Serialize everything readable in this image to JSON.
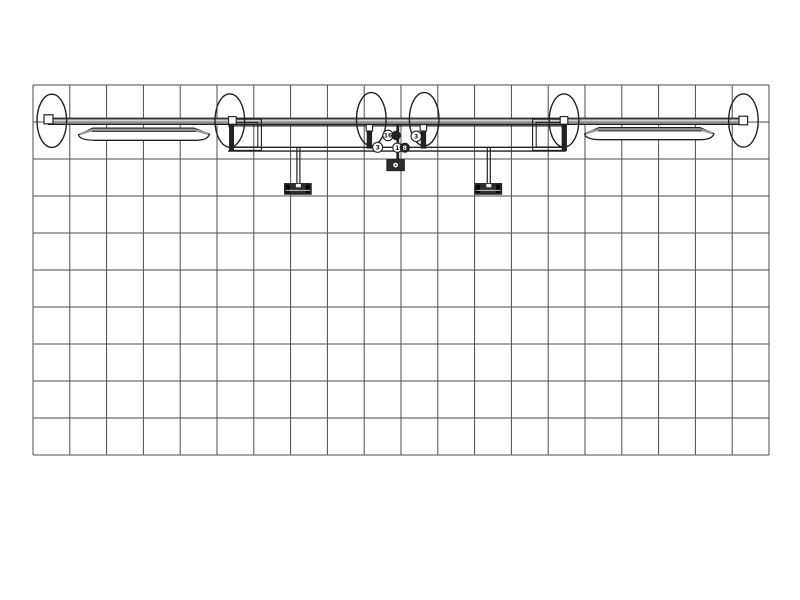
{
  "drawing": {
    "type": "trade-show-truss-display-plan",
    "grid": {
      "columns": 20,
      "rows": 10
    },
    "colors": {
      "line": "#222222",
      "grid_line": "#4c4c4c",
      "truss_fill": "#8f8f8f",
      "truss_highlight": "#dcdcdc",
      "dark_fill": "#2e2e2e",
      "background": "#ffffff"
    },
    "components": [
      "floor-grid",
      "horizontal-truss-beam",
      "truss-end-plug-left",
      "truss-end-plug-right",
      "truss-column-ellipses",
      "canopy-blade-left",
      "canopy-blade-right",
      "backwall-panel",
      "monitor-mount-left",
      "monitor-mount-right",
      "center-base-plate"
    ],
    "balloons": [
      {
        "label": "16"
      },
      {
        "label": ""
      },
      {
        "label": "3"
      },
      {
        "label": "1"
      },
      {
        "label": "8"
      },
      {
        "label": "3"
      }
    ]
  }
}
